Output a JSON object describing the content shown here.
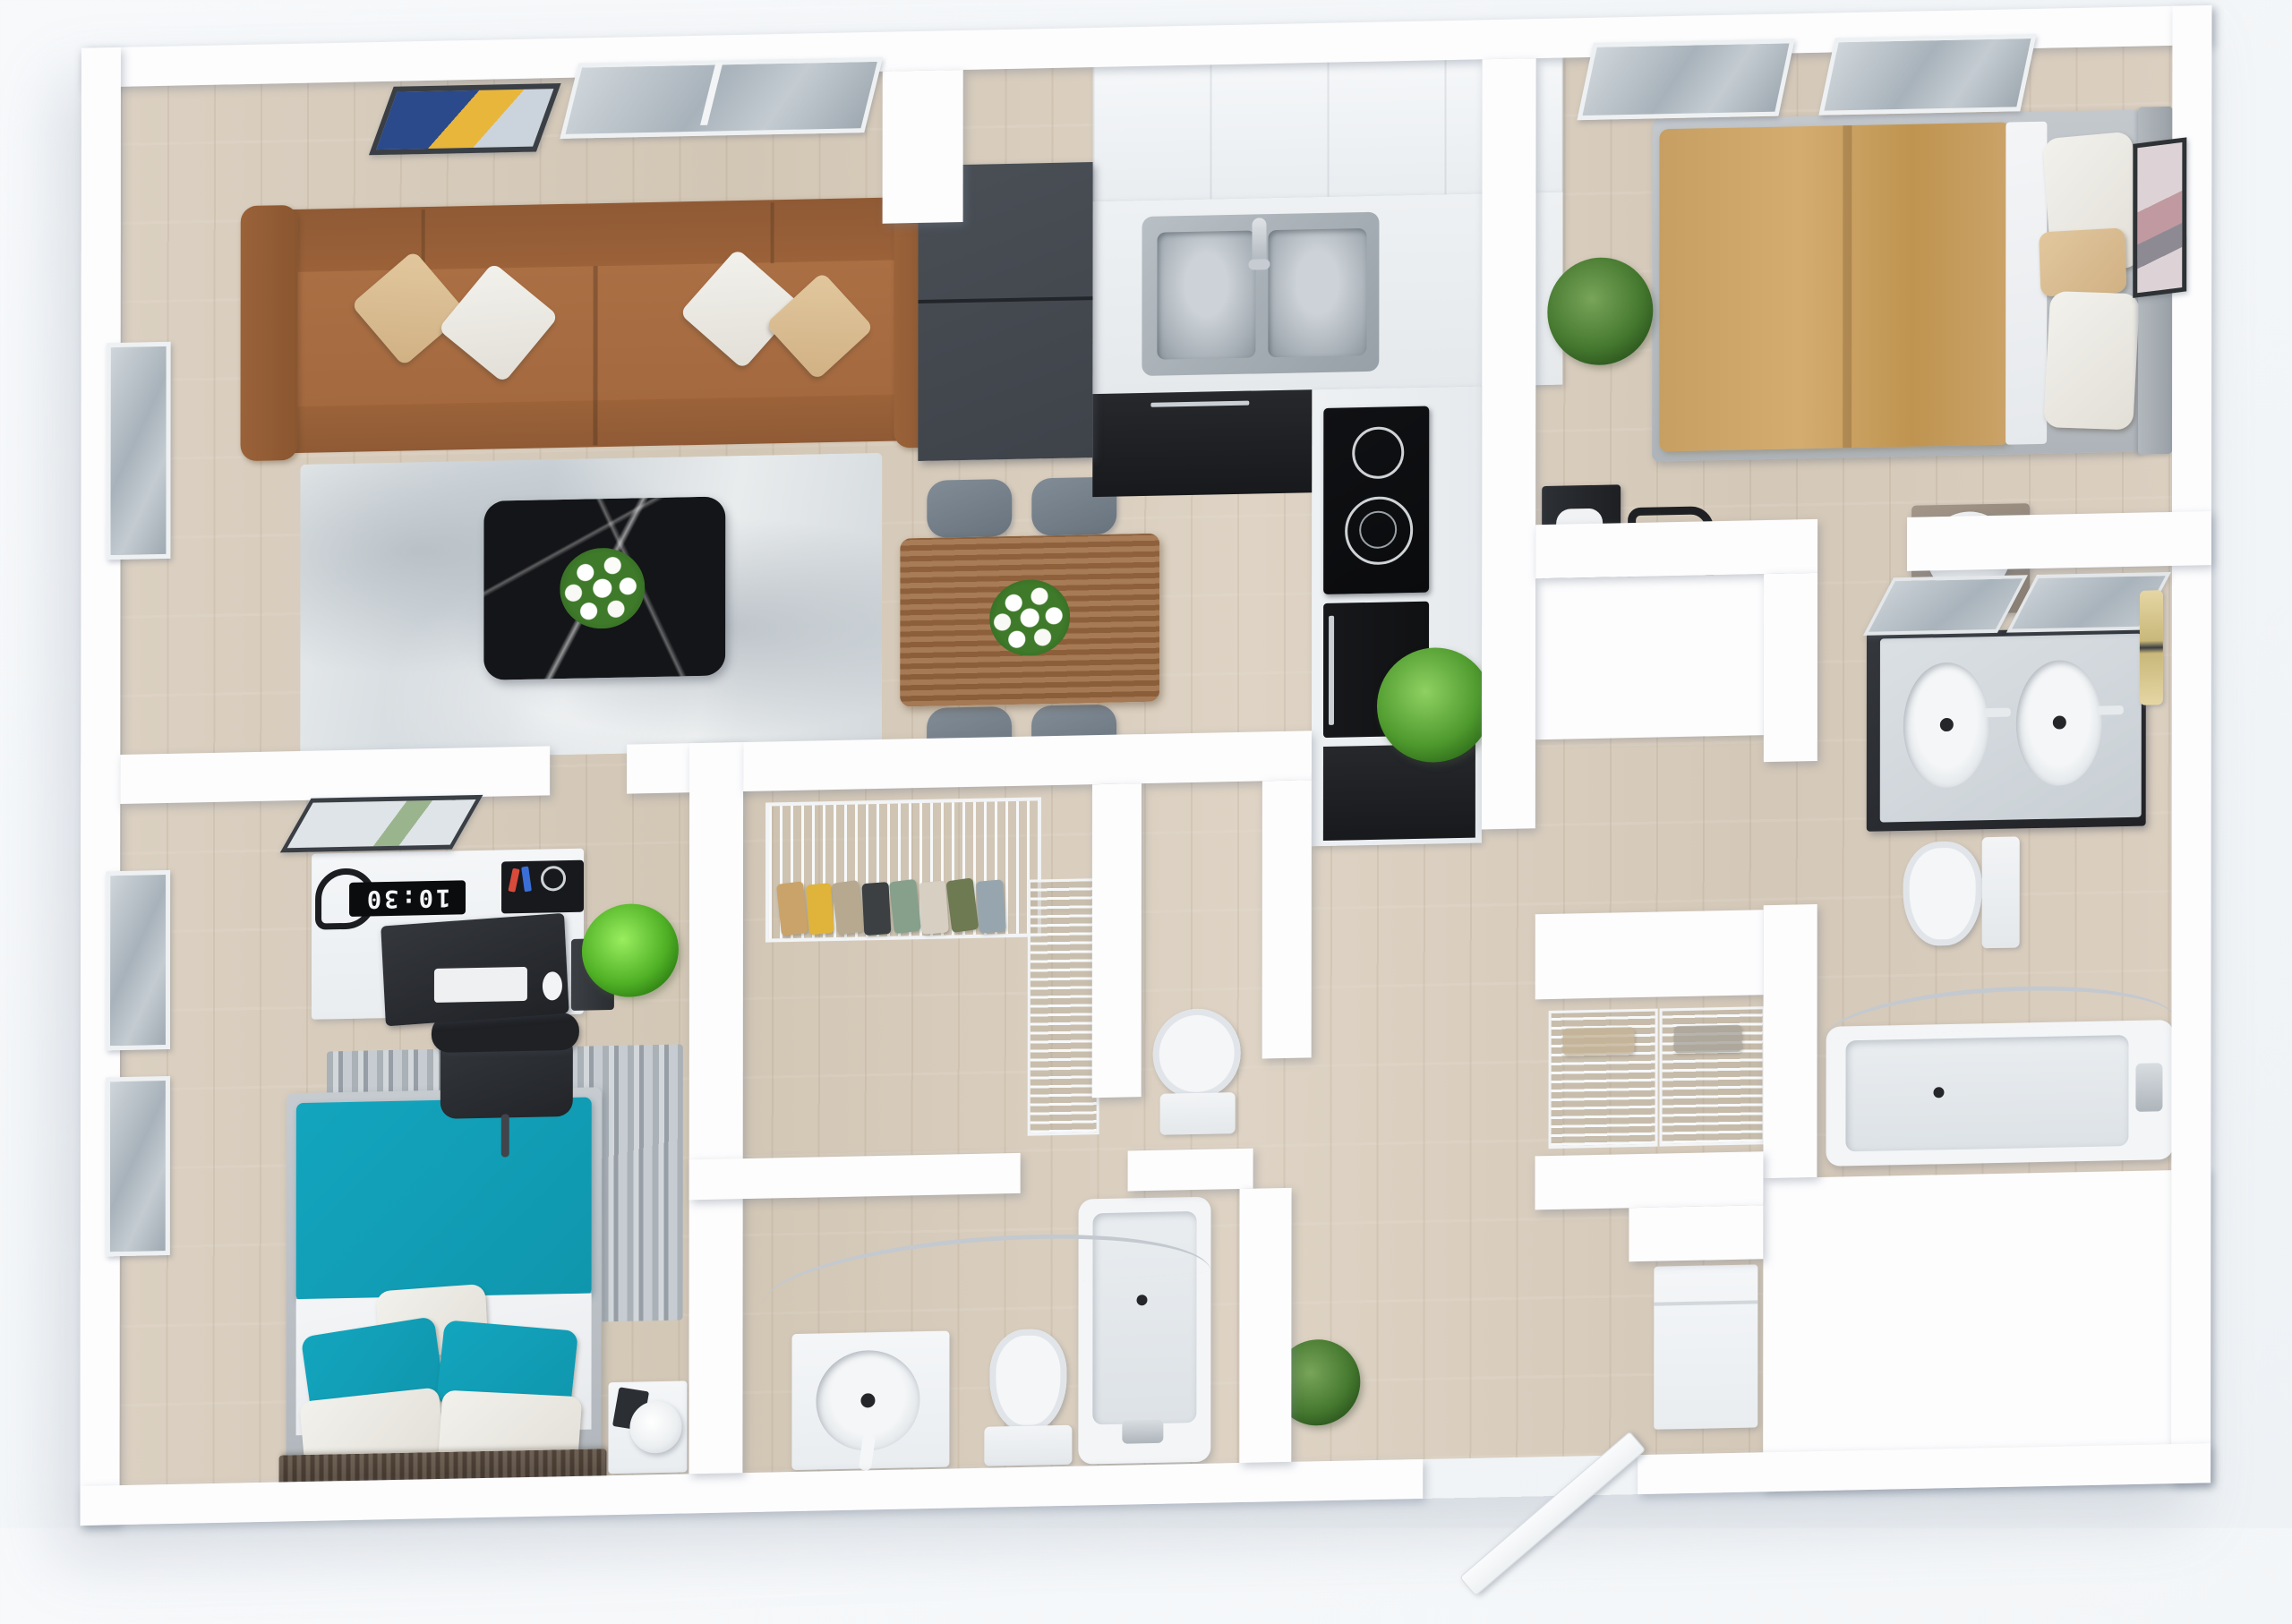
{
  "scene": {
    "title": "3D apartment floor plan render",
    "view": "top-down dollhouse",
    "clock_time": "10:30"
  },
  "colors": {
    "wall": "#fdfdfe",
    "floor_wood": "#d8ccbb",
    "sofa_brown": "#a4693f",
    "pillow_beige": "#d0b184",
    "pillow_white": "#e2dfd7",
    "rug_living": "#d3d9dd",
    "coffee_table_black": "#141518",
    "cabinet_dark": "#3e434a",
    "cabinet_black": "#17191c",
    "counter_white": "#eef1f3",
    "sink_steel": "#97a0a7",
    "dining_wood": "#95663f",
    "chair_gray": "#68737d",
    "bed_tan": "#c79f62",
    "bed_teal": "#0f96ad",
    "plant_green": "#4f9a2e",
    "glass": "#b9c2ca"
  },
  "rooms": [
    {
      "name": "living-room",
      "furniture": [
        "sofa",
        "throw-pillow-beige",
        "throw-pillow-white",
        "area-rug",
        "marble-coffee-table",
        "flower-bouquet",
        "wall-art",
        "window"
      ]
    },
    {
      "name": "kitchen",
      "furniture": [
        "refrigerator",
        "upper-cabinets",
        "double-sink",
        "faucet",
        "lower-cabinets",
        "cooktop",
        "oven",
        "base-cabinet",
        "plant"
      ]
    },
    {
      "name": "dining-area",
      "furniture": [
        "dining-table",
        "dining-chair",
        "centerpiece-flowers"
      ]
    },
    {
      "name": "bedroom-primary",
      "furniture": [
        "bed-tan",
        "pillows",
        "headboard",
        "nightstand",
        "table-lamp",
        "media-console",
        "chair",
        "wall-art",
        "window",
        "plant"
      ]
    },
    {
      "name": "bathroom-ensuite",
      "furniture": [
        "double-vanity",
        "mirror",
        "wall-sconce",
        "toilet",
        "bathtub",
        "shower-rod"
      ]
    },
    {
      "name": "walk-in-closet",
      "furniture": [
        "wire-shelf",
        "hanging-clothes",
        "wire-drawers"
      ]
    },
    {
      "name": "water-closet",
      "furniture": [
        "toilet"
      ]
    },
    {
      "name": "bathroom-main",
      "furniture": [
        "vanity",
        "round-sink",
        "toilet",
        "bathtub",
        "shower-rod"
      ]
    },
    {
      "name": "bedroom-second",
      "furniture": [
        "desk",
        "monitor",
        "digital-clock",
        "desk-organizer",
        "desk-lamp",
        "pc-tower",
        "office-chair",
        "striped-rug",
        "bed-teal",
        "pillows",
        "nightstand",
        "table-lamp",
        "book",
        "window",
        "wall-art",
        "plant"
      ]
    },
    {
      "name": "entry-hall",
      "furniture": [
        "entry-door-open",
        "wire-basket-closet",
        "washer",
        "plant"
      ]
    }
  ]
}
